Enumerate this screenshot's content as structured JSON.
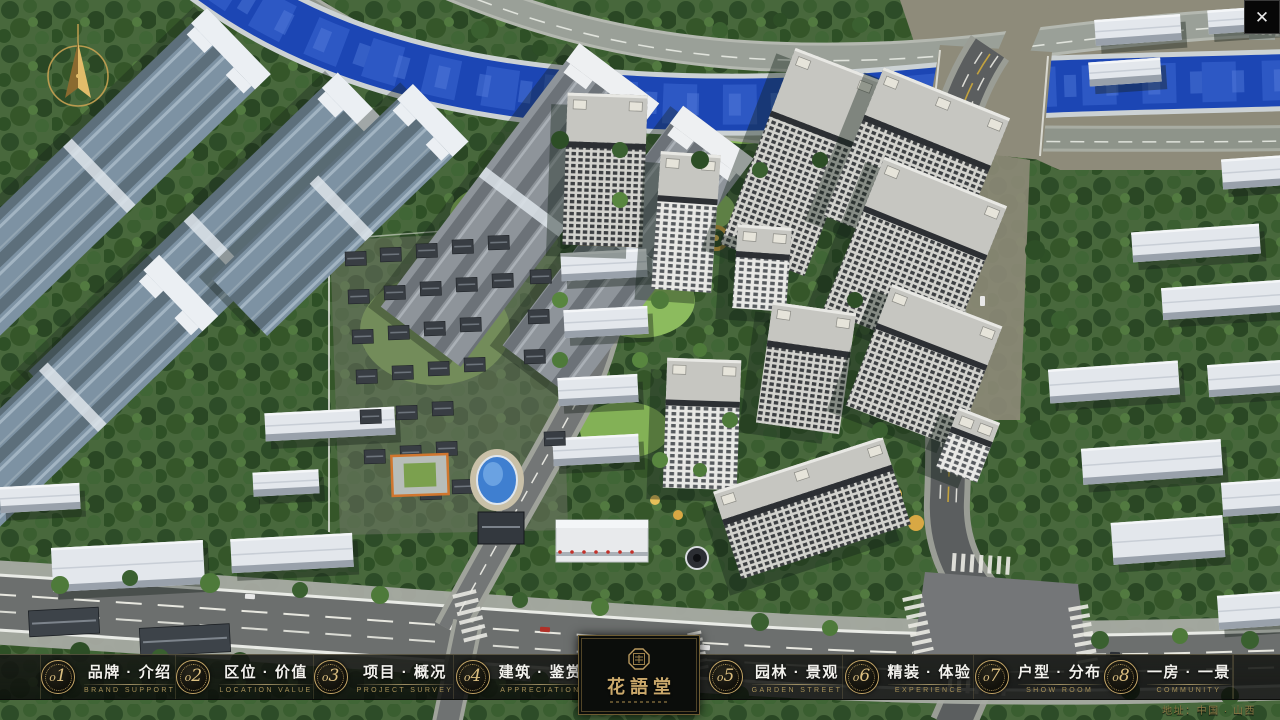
{
  "app": {
    "logo_name": "花語堂",
    "address": "地址：中国 · 山西",
    "close_symbol": "✕"
  },
  "nav": {
    "items": [
      {
        "num": "o1",
        "zh": "品牌 · 介绍",
        "en": "BRAND SUPPORT"
      },
      {
        "num": "o2",
        "zh": "区位 · 价值",
        "en": "LOCATION VALUE"
      },
      {
        "num": "o3",
        "zh": "项目 · 概况",
        "en": "PROJECT SURVEY"
      },
      {
        "num": "o4",
        "zh": "建筑 · 鉴赏",
        "en": "APPRECIATION"
      },
      {
        "num": "o5",
        "zh": "园林 · 景观",
        "en": "GARDEN STREET"
      },
      {
        "num": "o6",
        "zh": "精装 · 体验",
        "en": "EXPERIENCE"
      },
      {
        "num": "o7",
        "zh": "户型 · 分布",
        "en": "SHOW ROOM"
      },
      {
        "num": "o8",
        "zh": "一房 · 一景",
        "en": "COMMUNITY"
      }
    ]
  },
  "colors": {
    "accent_gold": "#c9a76a",
    "bar_background": "#0d0f0d",
    "river_blue": "#1c46b4",
    "tree_green": "#3a5c2f",
    "road_gray": "#6b6e6d",
    "tower_facade": "#d2d2cd",
    "left_slab_blue": "#7d92a3"
  }
}
